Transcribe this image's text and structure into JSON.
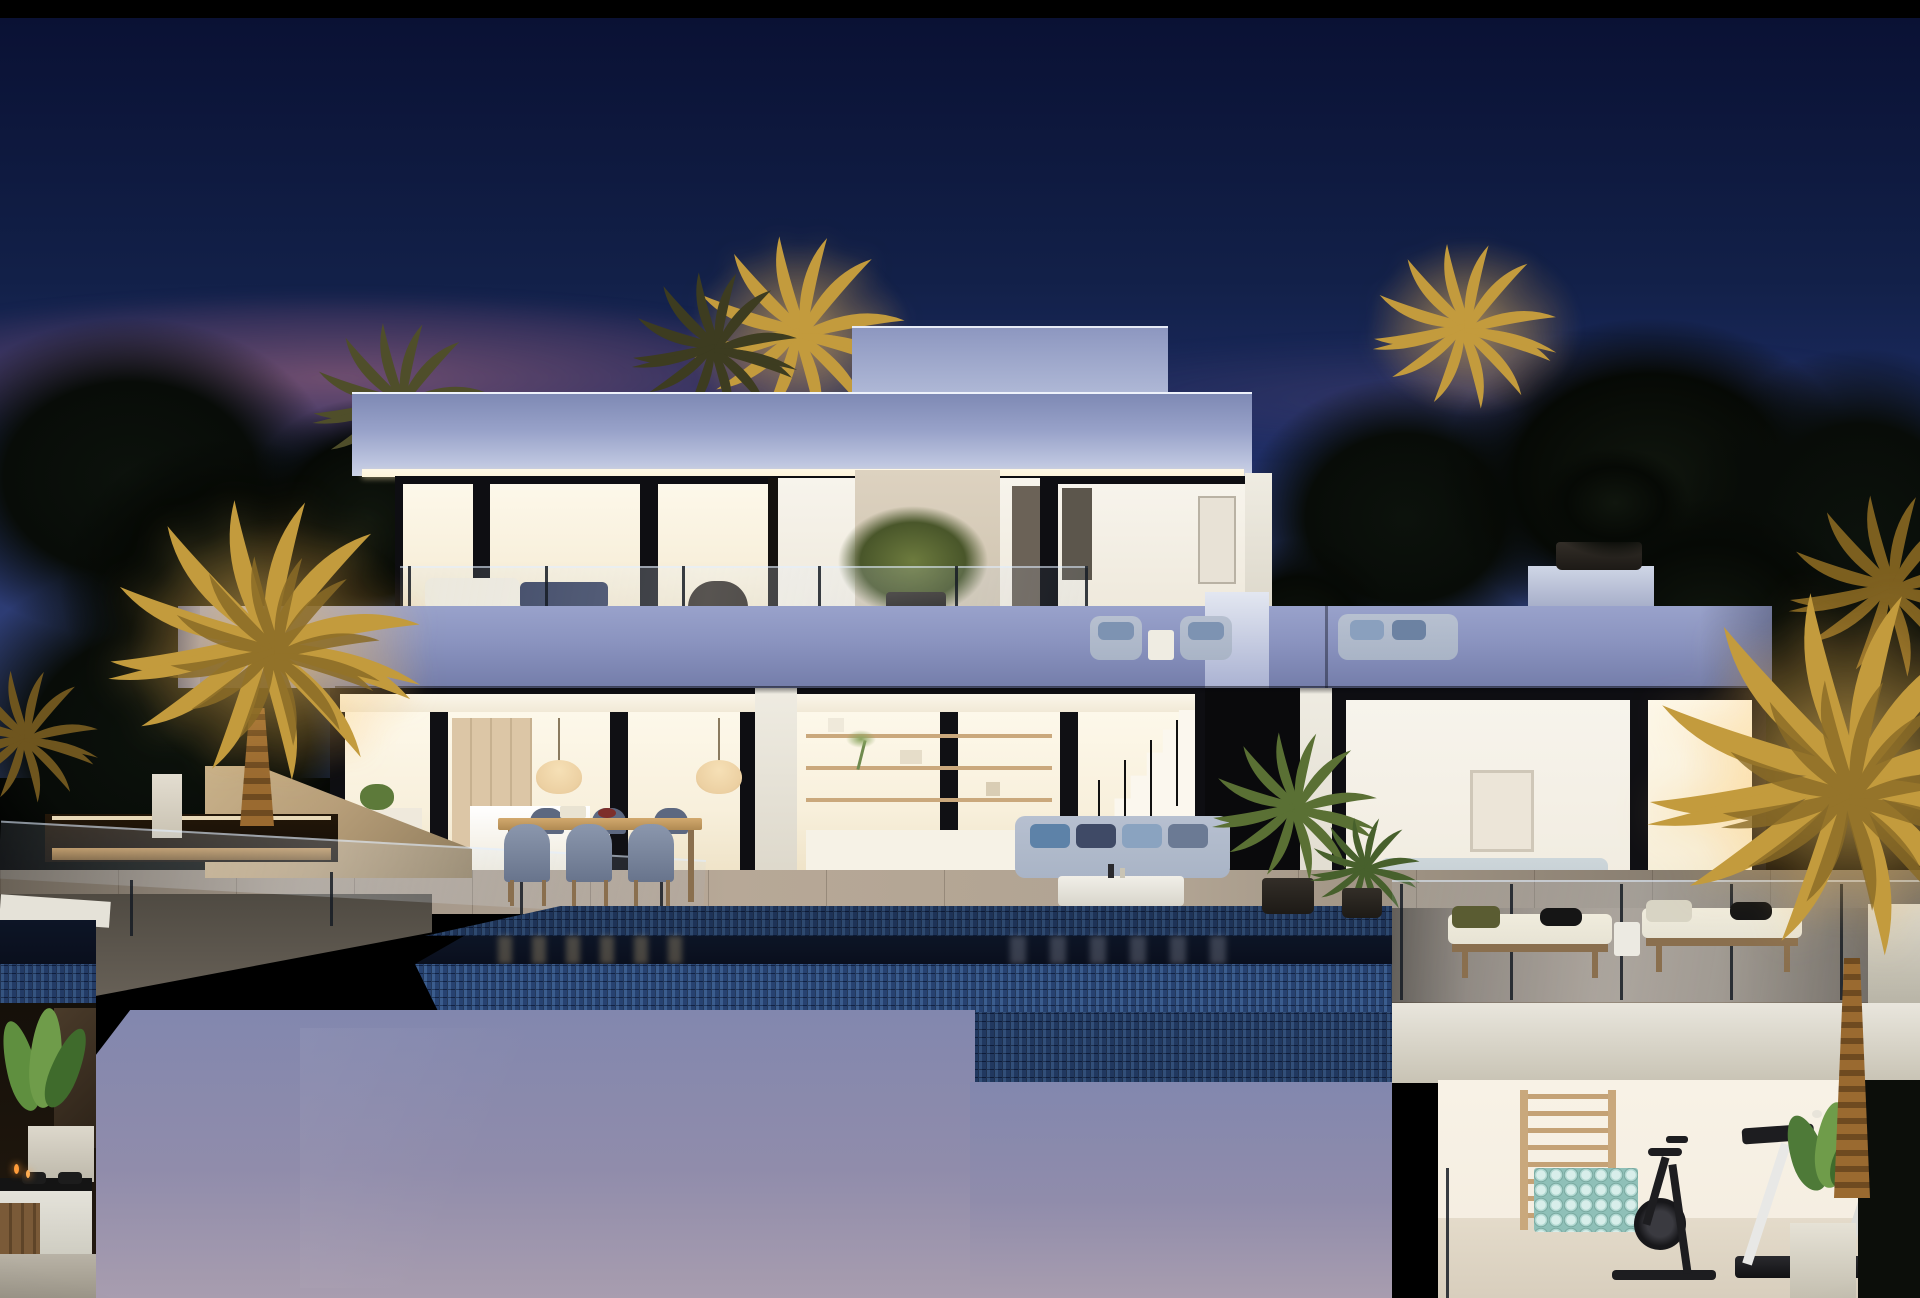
{
  "scene": {
    "type": "architectural-dusk-render",
    "description": "Photorealistic dusk rendering of a modern two-storey white luxury villa with flat cantilevered slabs, floor-to-ceiling glazing glowing warm from inside, an upper terrace with outdoor sofas and a potted tree, a ground floor showing kitchen, dining shelving, staircase and bedroom, an outdoor dining table with six chairs, an outdoor lounge sofa, two sun loungers, a mosaic-edged infinity pool reflecting the lit interior, a tall lavender retaining wall below, a spa corner with jacuzzi and strelitzia plant at lower left, a basement gym with wall bars, rolled mats, exercise bike and treadmill at lower right, and golden uplit palm trees against a deep blue night sky with a pink sunset band.",
    "time_of_day": "dusk",
    "elements": [
      "night-sky",
      "sunset-glow",
      "dark-tree-silhouettes",
      "uplit-palm-trees",
      "penthouse-volume",
      "flat-roof-slab",
      "lit-soffit",
      "upper-floor-glazing",
      "upper-terrace-sofa",
      "upper-terrace-potted-tree",
      "terrace-glass-balustrade",
      "mid-floor-slab-band",
      "ground-floor-glazing",
      "kitchen-interior",
      "pendant-lamps",
      "shelving-unit",
      "interior-staircase",
      "bedroom-interior",
      "bed-with-headboard",
      "outdoor-dining-table",
      "dining-chairs",
      "outdoor-sofa",
      "coffee-table",
      "sun-loungers",
      "potted-palms",
      "travertine-deck",
      "infinity-pool",
      "mosaic-pool-edge",
      "pool-reflections",
      "lavender-retaining-wall",
      "garage-opening",
      "stone-wall",
      "glass-railing-ramp",
      "spa-jacuzzi",
      "strelitzia-planter",
      "basement-gym",
      "wall-bars",
      "rolled-mats-stack",
      "exercise-bike",
      "treadmill",
      "white-cube-planter"
    ]
  },
  "palette": {
    "sky_top": "#0a1134",
    "sky_mid": "#1d2c63",
    "sky_horizon": "#39497f",
    "dusk_pink": "#8a5f74",
    "palm_gold": "#c39b3d",
    "palm_gold_dark": "#7c5f1f",
    "palm_olive": "#4f4e2a",
    "foliage_dark": "#080c08",
    "roof_top": "#7e89b4",
    "roof_bottom": "#ccd3e8",
    "penthouse": "#b2bbd8",
    "soffit_glow": "#fdf4da",
    "band_top": "#99a2cb",
    "band_bottom": "#747daa",
    "frame_dark": "#0e0e12",
    "interior_warm": "#f8f0dc",
    "interior_bright": "#fdf8ea",
    "kitchen_wood": "#dcc6a6",
    "pendant": "#ecd0a2",
    "mosaic_tile": "#2e4c7c",
    "mosaic_grout": "#101f3e",
    "water_dark": "#0a0f1d",
    "deck_light": "#b7a897",
    "deck_dark": "#6e665b",
    "wall_top": "#8287ae",
    "wall_bottom": "#a89daf",
    "lounger_cushion": "#e7e3d4",
    "wood_warm": "#8a6f4e",
    "sofa_blue": "#a9b4c6",
    "cushion_navy": "#2c3553",
    "gym_wall": "#f3ecdf",
    "gym_floor": "#d8cebd",
    "mat_mint": "#aed6cf",
    "equip_dark": "#1d1d20",
    "plant_green": "#4e7a38",
    "spa_white": "#e9e7df",
    "stone_warm": "#b79e79",
    "curb_white": "#e5e2d8"
  }
}
